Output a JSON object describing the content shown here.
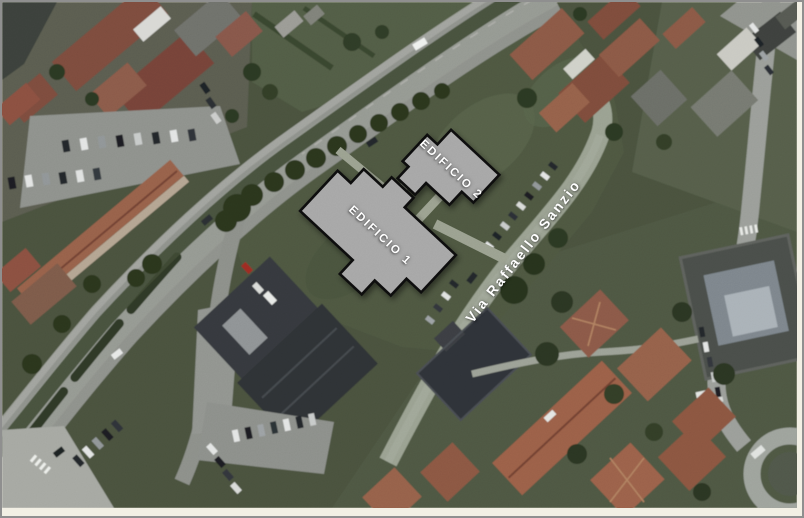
{
  "image": {
    "type": "aerial-satellite-site-plan",
    "overlays": {
      "building_1": {
        "label": "EDIFICIO 1"
      },
      "building_2": {
        "label": "EDIFICIO 2"
      },
      "street": {
        "label": "Via Raffaello Sanzio"
      }
    },
    "colors": {
      "overlay_building_fill": "#a6a6a6",
      "overlay_building_outline": "#0d0d0d",
      "overlay_label_text": "#ffffff",
      "street_label_text": "#ffffff",
      "frame_background": "#f2efe4",
      "frame_border": "#8f8f8f"
    }
  }
}
